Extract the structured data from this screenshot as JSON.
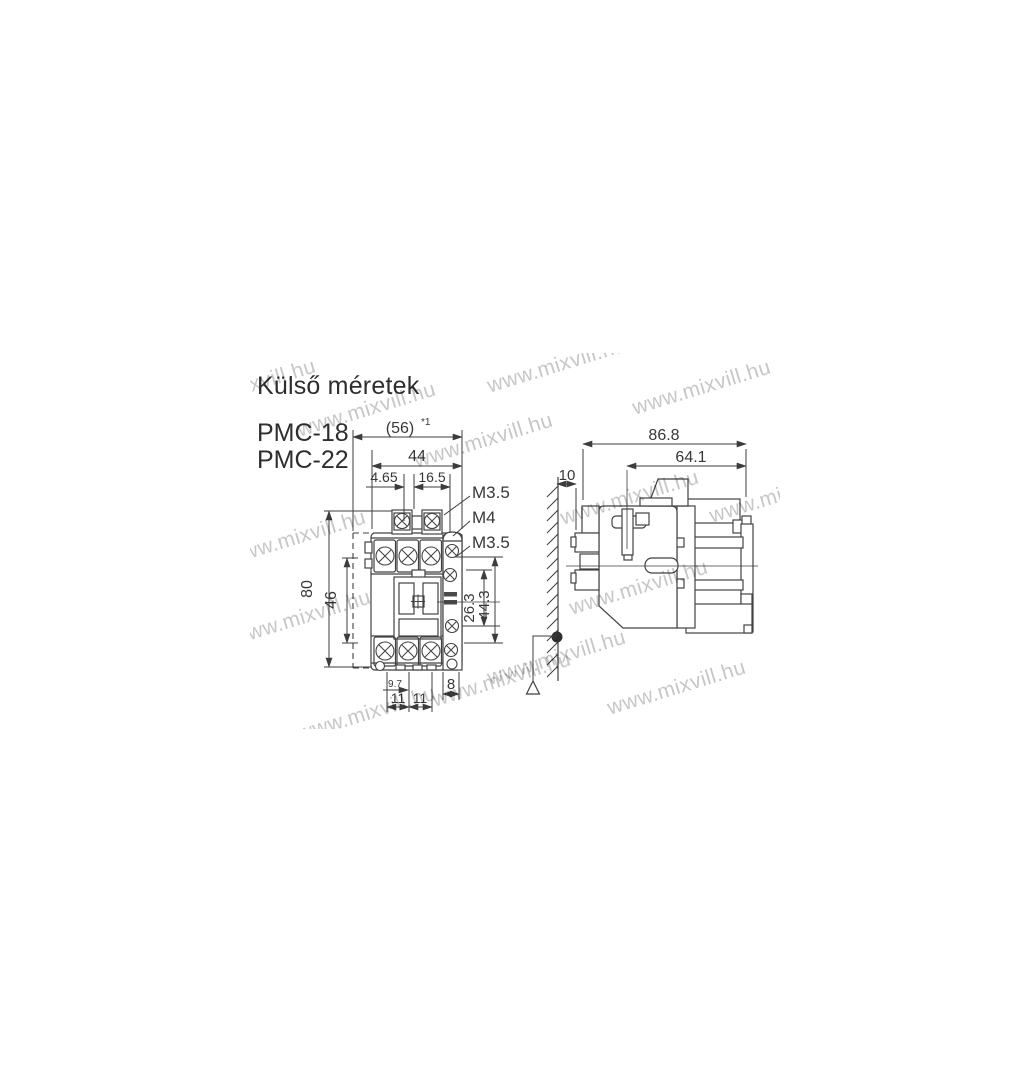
{
  "title": "Külső méretek",
  "models": [
    "PMC-18",
    "PMC-22"
  ],
  "watermark": {
    "text": "www.mixvill.hu",
    "color": "#c7c7c7"
  },
  "colors": {
    "line": "#424242",
    "text": "#383838",
    "background": "#ffffff"
  },
  "front_view": {
    "dims": {
      "w56": "(56)",
      "w56_note": "*1",
      "w44": "44",
      "a465": "4.65",
      "a165": "16.5",
      "m35_top": "M3.5",
      "m4": "M4",
      "m35_side": "M3.5",
      "h80": "80",
      "h46": "46",
      "v263": "26.3",
      "v443": "44.3",
      "b97": "9.7",
      "b11a": "11",
      "b11b": "11",
      "b8": "8"
    }
  },
  "side_view": {
    "dims": {
      "d868": "86.8",
      "d641": "64.1",
      "d10": "10"
    }
  }
}
